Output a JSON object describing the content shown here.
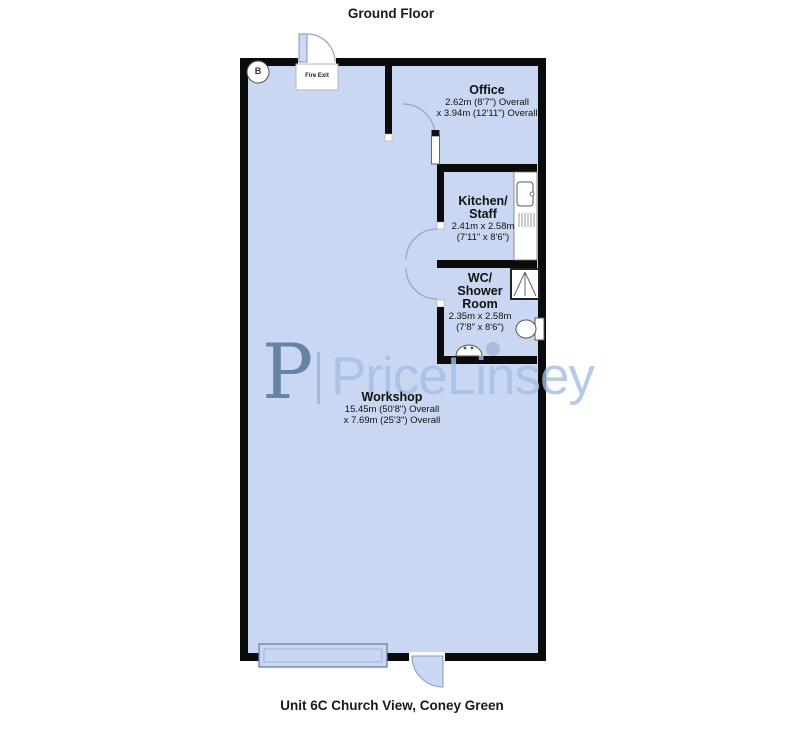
{
  "title": "Ground Floor",
  "footer": "Unit 6C Church View, Coney Green",
  "watermark": {
    "logo_letter": "P",
    "brand": "PriceLinsey"
  },
  "markers": {
    "fire_exit": "Fire Exit",
    "corner_badge": "B"
  },
  "rooms": {
    "office": {
      "name": "Office",
      "dim_line1": "2.62m (8'7\") Overall",
      "dim_line2": "x 3.94m (12'11\") Overall"
    },
    "kitchen": {
      "name_line1": "Kitchen/",
      "name_line2": "Staff",
      "dim_line1": "2.41m x 2.58m",
      "dim_line2": "(7'11\" x 8'6\")"
    },
    "wc": {
      "name_line1": "WC/",
      "name_line2": "Shower",
      "name_line3": "Room",
      "dim_line1": "2.35m x 2.58m",
      "dim_line2": "(7'8\" x 8'6\")"
    },
    "workshop": {
      "name": "Workshop",
      "dim_line1": "15.45m (50'8\") Overall",
      "dim_line2": "x 7.69m (25'3\") Overall"
    }
  },
  "colors": {
    "room_fill": "#c9d7f2",
    "wall": "#0b0b0b",
    "watermark_logo": "#4a6b91",
    "watermark_text": "#a4bee4"
  }
}
